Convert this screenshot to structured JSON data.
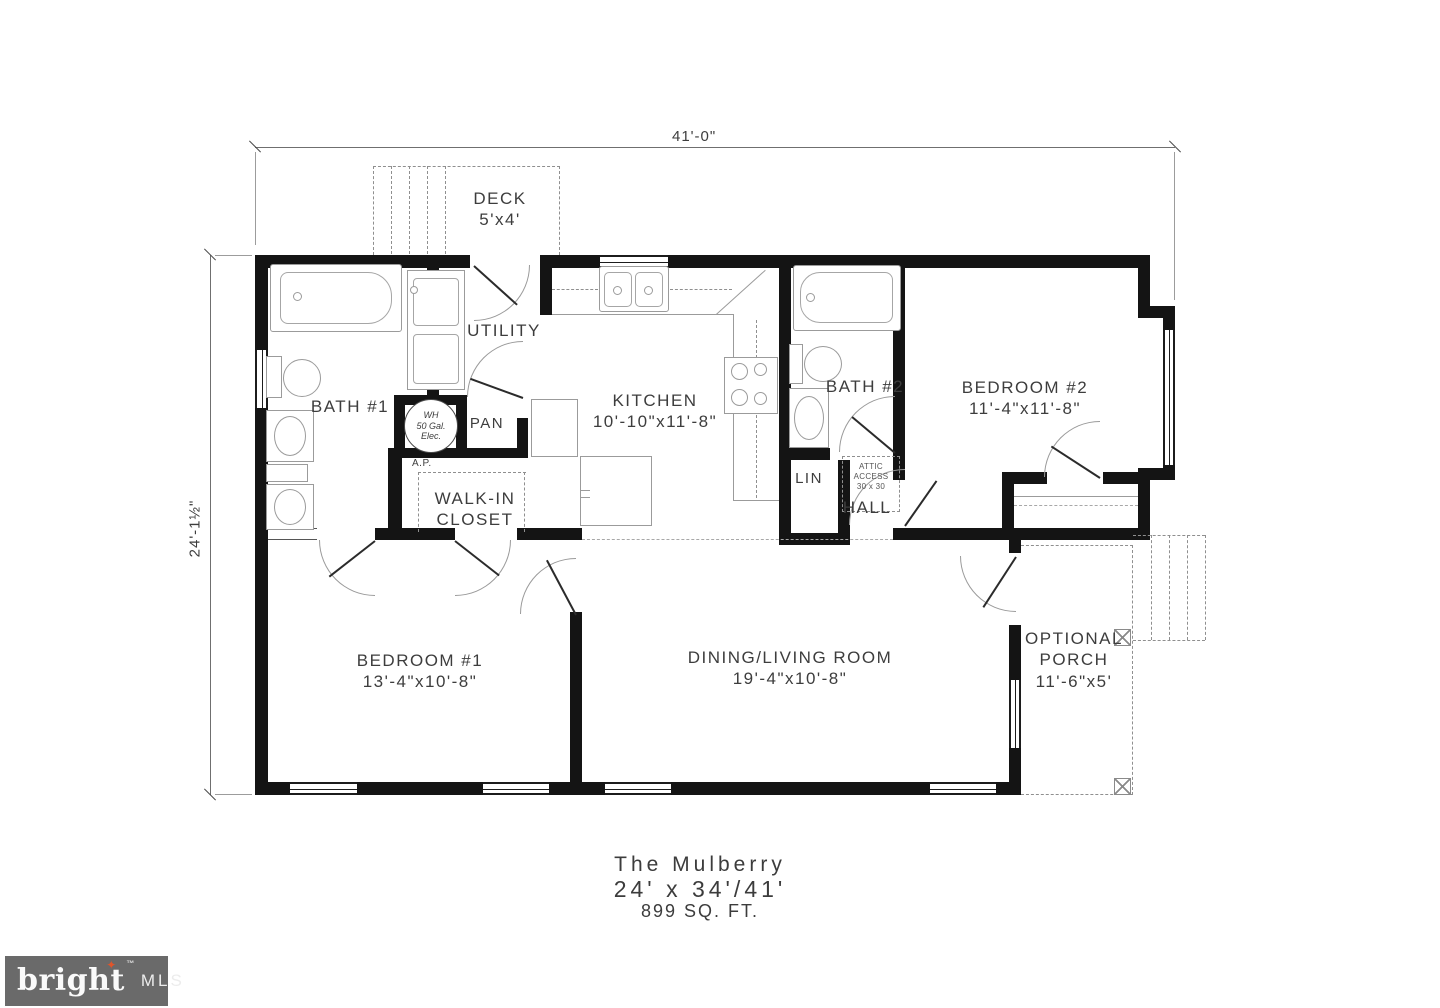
{
  "dimensions": {
    "overall_width": "41'-0\"",
    "overall_depth": "24'-1½\""
  },
  "rooms": {
    "deck": {
      "name": "DECK",
      "size": "5'x4'"
    },
    "utility": {
      "name": "UTILITY"
    },
    "bath1": {
      "name": "BATH #1"
    },
    "water_heater": {
      "line1": "WH",
      "line2": "50 Gal.",
      "line3": "Elec."
    },
    "pantry": {
      "name": "PAN"
    },
    "access_panel": {
      "name": "A.P."
    },
    "walk_in_closet": {
      "line1": "WALK-IN",
      "line2": "CLOSET"
    },
    "kitchen": {
      "name": "KITCHEN",
      "size": "10'-10\"x11'-8\""
    },
    "bath2": {
      "name": "BATH #2"
    },
    "linen": {
      "name": "LIN"
    },
    "attic_access": {
      "line1": "ATTIC",
      "line2": "ACCESS",
      "line3": "30 x 30"
    },
    "hall": {
      "name": "HALL"
    },
    "bedroom2": {
      "name": "BEDROOM #2",
      "size": "11'-4\"x11'-8\""
    },
    "bedroom1": {
      "name": "BEDROOM #1",
      "size": "13'-4\"x10'-8\""
    },
    "living": {
      "name": "DINING/LIVING ROOM",
      "size": "19'-4\"x10'-8\""
    },
    "porch": {
      "line1": "OPTIONAL",
      "line2": "PORCH",
      "size": "11'-6\"x5'"
    }
  },
  "title_block": {
    "plan_name": "The Mulberry",
    "plan_size": "24' x 34'/41'",
    "plan_area": "899 SQ. FT."
  },
  "logo": {
    "brand": "bright",
    "trademark": "™",
    "suffix": "MLS",
    "star_icon": "✦",
    "background_color": "#6a6a6a",
    "star_color": "#e0552b"
  },
  "colors": {
    "wall": "#141414",
    "fixture_line": "#9b9b9b",
    "text": "#3d3d3d"
  }
}
